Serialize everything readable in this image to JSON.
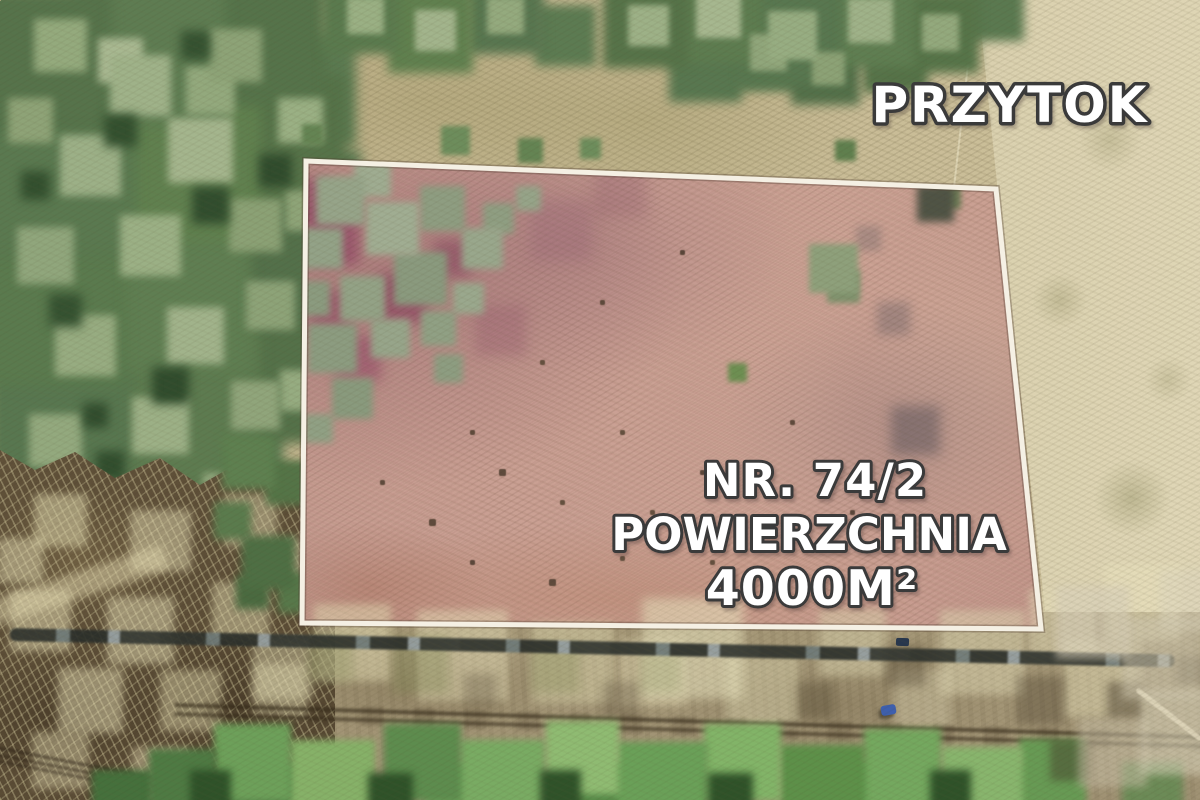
{
  "overlay": {
    "location_label": "PRZYTOK",
    "plot_number": "NR. 74/2",
    "area_label": "POWIERZCHNIA",
    "area_value": "4000M²"
  },
  "boundary": {
    "points": "306,161 996,189 1041,629 302,623",
    "stroke_color": "#f5f0e4"
  },
  "palette": {
    "text_fill": "#ffffff",
    "text_outline": "#3a3a3a",
    "plot_fill": "#c49b90",
    "forest_green": "#5c7a50",
    "field_tan": "#c9bd98",
    "vehicle_blue": "#3d5fae"
  }
}
